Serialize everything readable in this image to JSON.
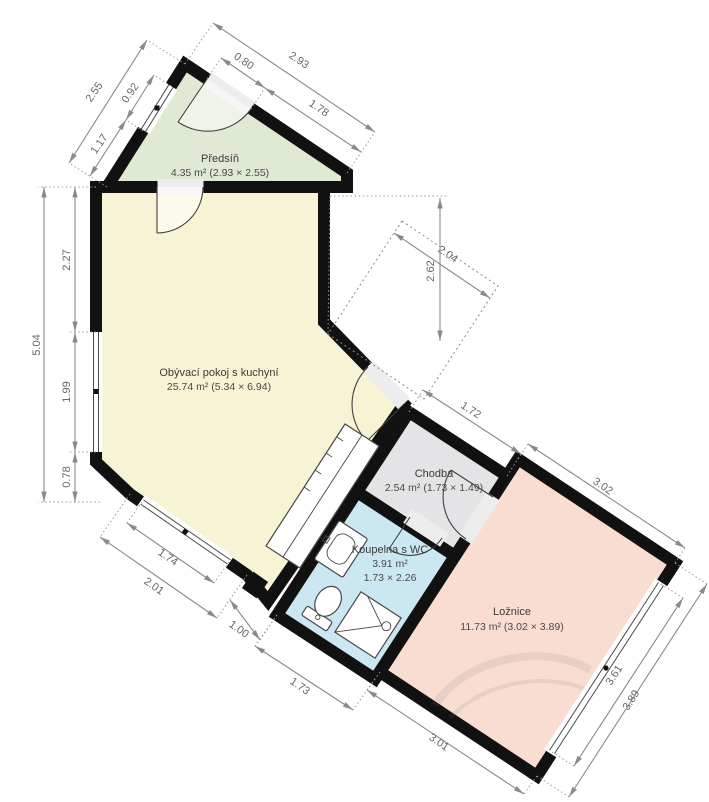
{
  "rooms": [
    {
      "name": "Předsíň",
      "area": "4.35 m² (2.93 × 2.55)"
    },
    {
      "name": "Obývací pokoj s kuchyní",
      "area": "25.74 m² (5.34 × 6.94)"
    },
    {
      "name": "Chodba",
      "area": "2.54 m² (1.73 × 1.49)"
    },
    {
      "name": "Koupelna s WC",
      "area": "3.91 m²",
      "dims": "1.73 × 2.26"
    },
    {
      "name": "Ložnice",
      "area": "11.73 m² (3.02 × 3.89)"
    }
  ],
  "dims": {
    "hall_top": "2.93",
    "hall_door": "0.80",
    "hall_top_right": "1.78",
    "hall_left": "2.55",
    "hall_window": "0.92",
    "hall_left_lower": "1.17",
    "left_total": "5.04",
    "left_upper": "2.27",
    "left_window": "1.99",
    "left_lower": "0.78",
    "sw_window": "1.74",
    "sw_wall": "2.01",
    "bottom_step": "1.00",
    "bath_bottom": "1.73",
    "bedroom_bottom": "3.01",
    "court_w": "2.04",
    "court_h": "2.62",
    "chodba_top": "1.72",
    "bedroom_top": "3.02",
    "bedroom_window": "3.61",
    "bedroom_right": "3.89"
  },
  "colors": {
    "hall": "#dfe9d4",
    "living": "#f7f4d6",
    "chodba": "#e4e4e6",
    "bath": "#cbe8f2",
    "bedroom": "#f9ddd0",
    "wall": "#111111",
    "dim": "#8a8a8a"
  }
}
